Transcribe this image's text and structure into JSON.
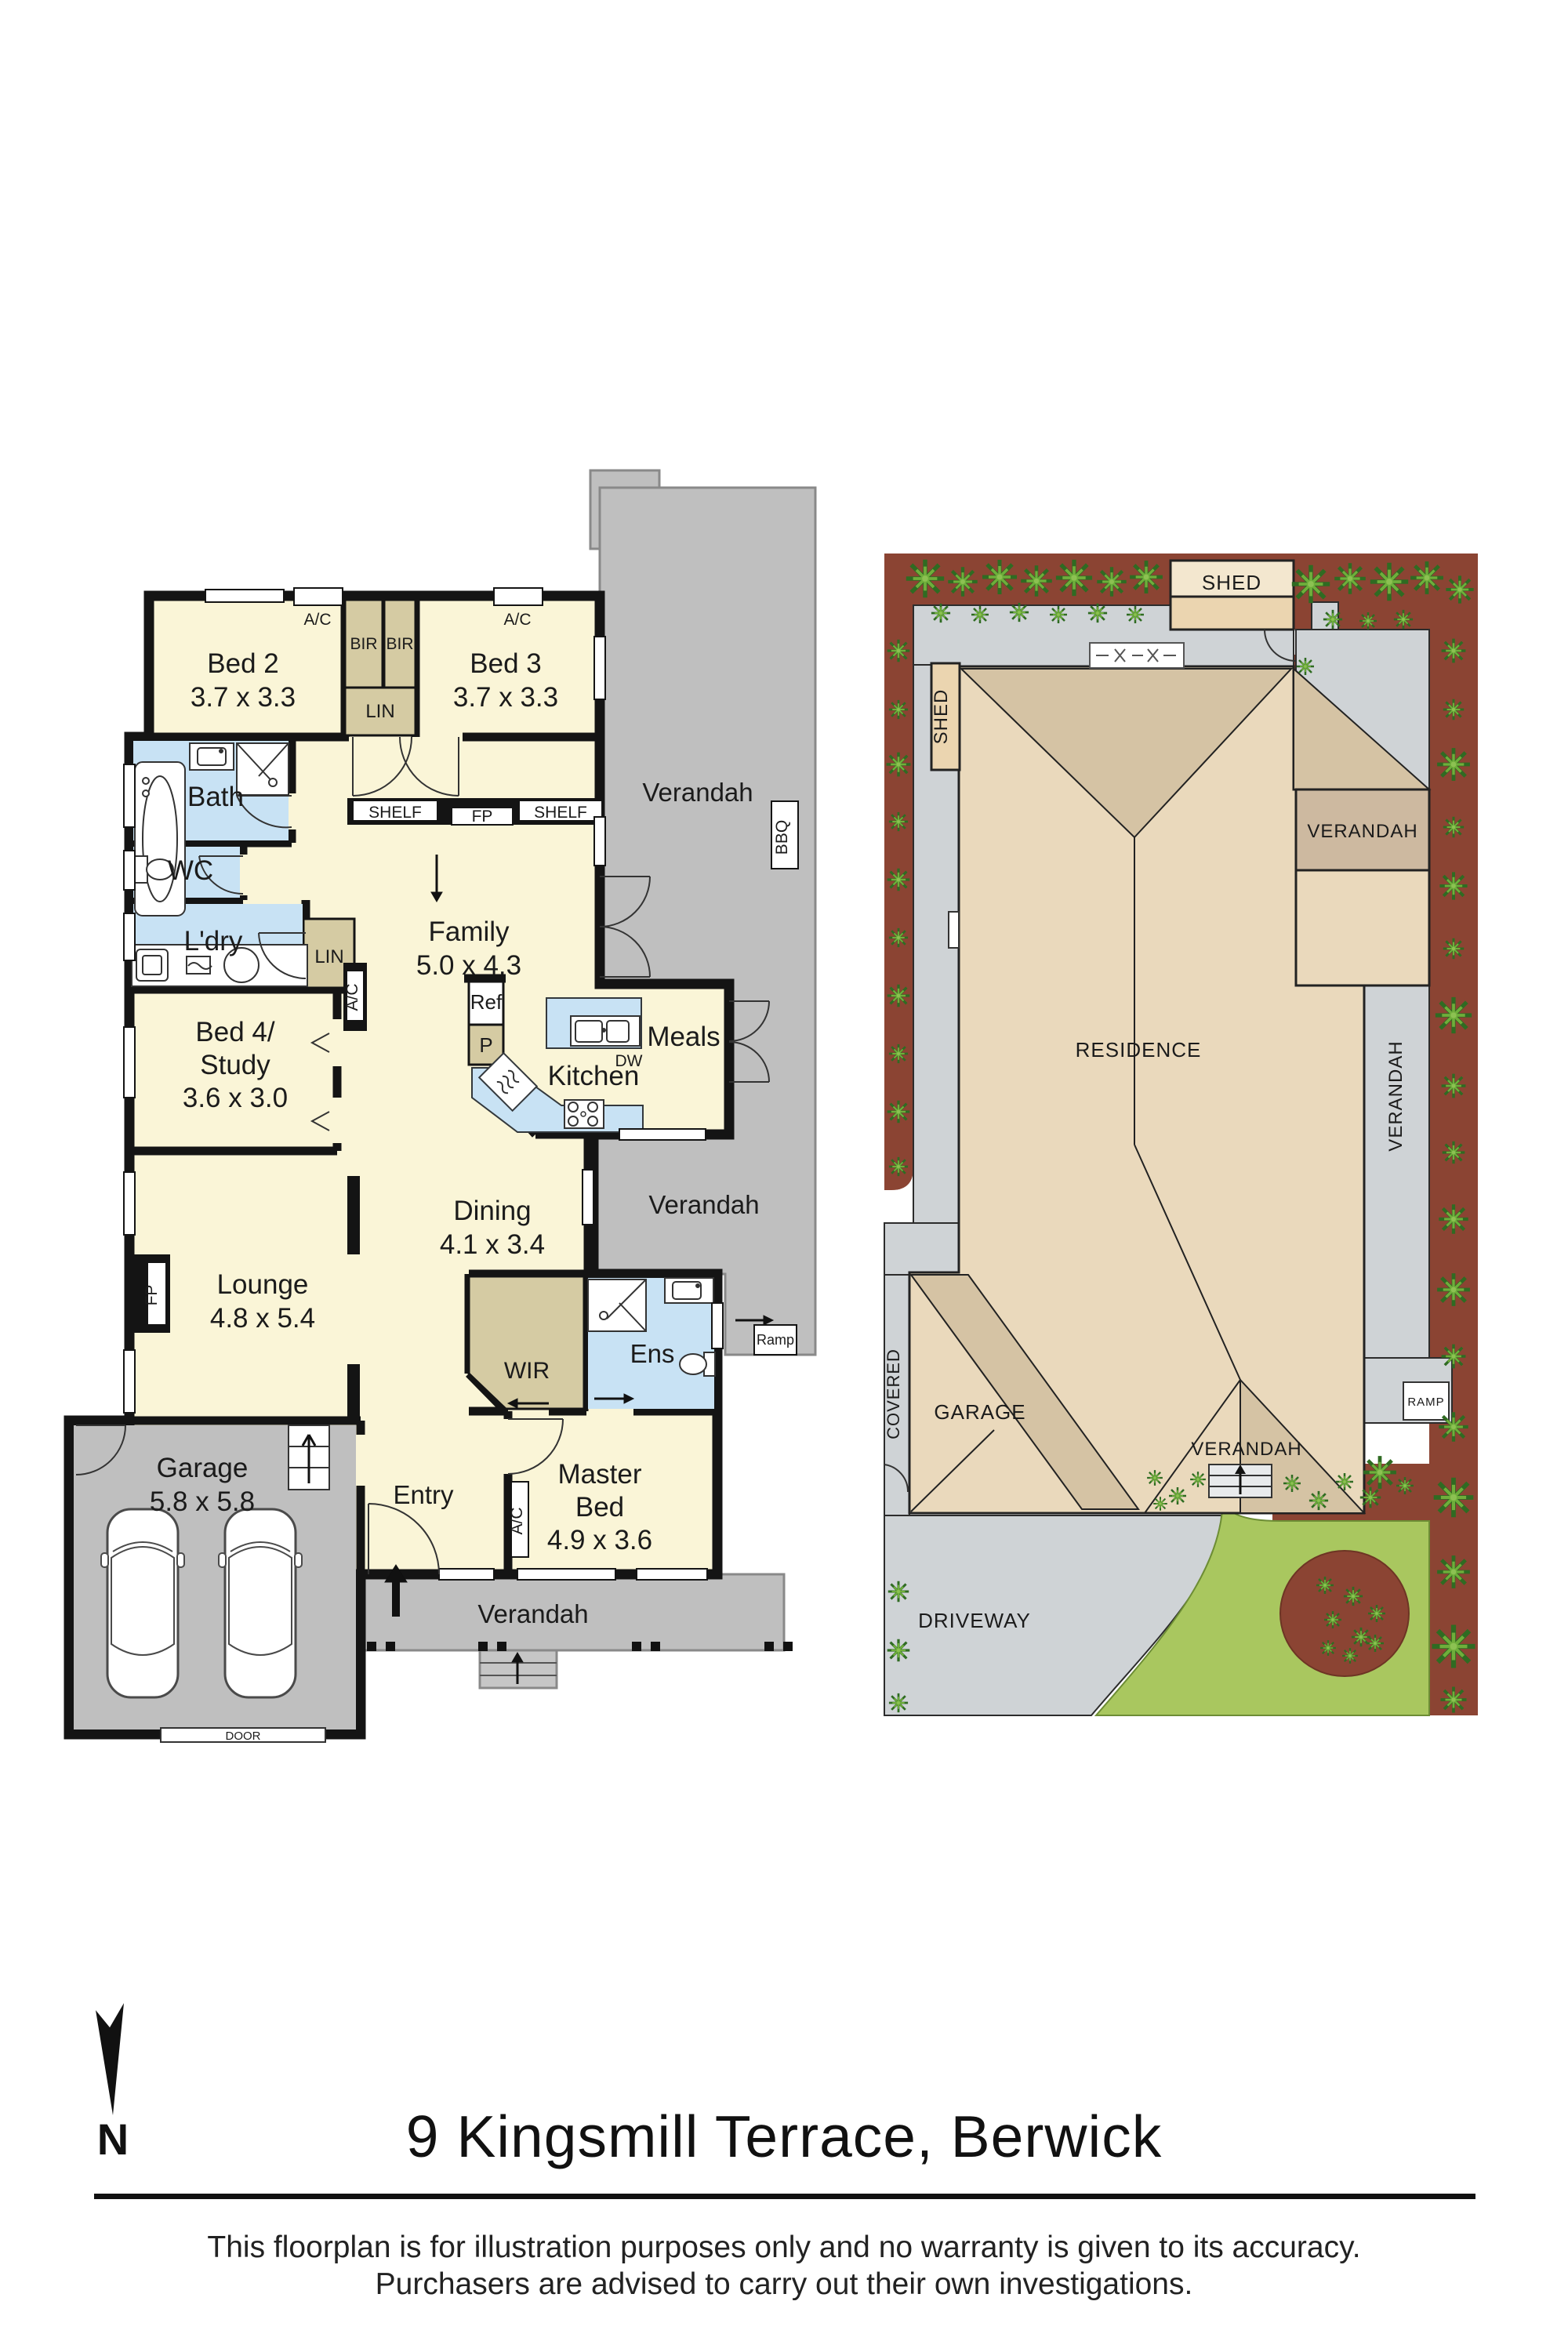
{
  "page_title": "9 Kingsmill Terrace, Berwick",
  "north_letter": "N",
  "disclaimer": {
    "line1": "This floorplan is for illustration purposes only and no warranty is given to its accuracy.",
    "line2": "Purchasers are advised to carry out their own investigations."
  },
  "floor_plan": {
    "bed2": {
      "name": "Bed 2",
      "dims": "3.7 x 3.3"
    },
    "bed3": {
      "name": "Bed 3",
      "dims": "3.7 x 3.3"
    },
    "bed4": {
      "line1": "Bed 4/",
      "line2": "Study",
      "dims": "3.6 x 3.0"
    },
    "master": {
      "line1": "Master",
      "line2": "Bed",
      "dims": "4.9 x 3.6"
    },
    "lounge": {
      "name": "Lounge",
      "dims": "4.8 x 5.4"
    },
    "family": {
      "name": "Family",
      "dims": "5.0 x 4.3"
    },
    "dining": {
      "name": "Dining",
      "dims": "4.1 x 3.4"
    },
    "garage": {
      "name": "Garage",
      "dims": "5.8 x 5.8"
    },
    "kitchen": "Kitchen",
    "meals": "Meals",
    "bath": "Bath",
    "wc": "WC",
    "laundry": "L'dry",
    "entry": "Entry",
    "ens": "Ens",
    "wir": "WIR",
    "verandah": "Verandah",
    "ramp": "Ramp",
    "bbq": "BBQ",
    "door": "DOOR",
    "shelf": "SHELF",
    "fireplace": "FP",
    "linen": "LIN",
    "robe": "BIR",
    "fridge": "Ref",
    "pantry": "P",
    "dishwasher": "DW",
    "ac": "A/C"
  },
  "site_plan": {
    "shed": "SHED",
    "residence": "RESIDENCE",
    "verandah": "VERANDAH",
    "covered": "COVERED",
    "garage": "GARAGE",
    "ramp": "RAMP",
    "driveway": "DRIVEWAY"
  },
  "colors": {
    "room_cream": "#FAF5D7",
    "wet_blue": "#C8E2F4",
    "robe_tan": "#D5CBA3",
    "verandah_gray": "#BFBFBF",
    "wall_black": "#141414",
    "garden_brown": "#8B4433",
    "path_gray": "#CFD3D6",
    "roof_light": "#EAD9BC",
    "roof_dark": "#D5C3A4",
    "shed_tan": "#EBD5B0",
    "verandah_tan": "#CDB9A0",
    "lawn_green": "#A9C75F",
    "plant_green": "#4C8A2E"
  }
}
